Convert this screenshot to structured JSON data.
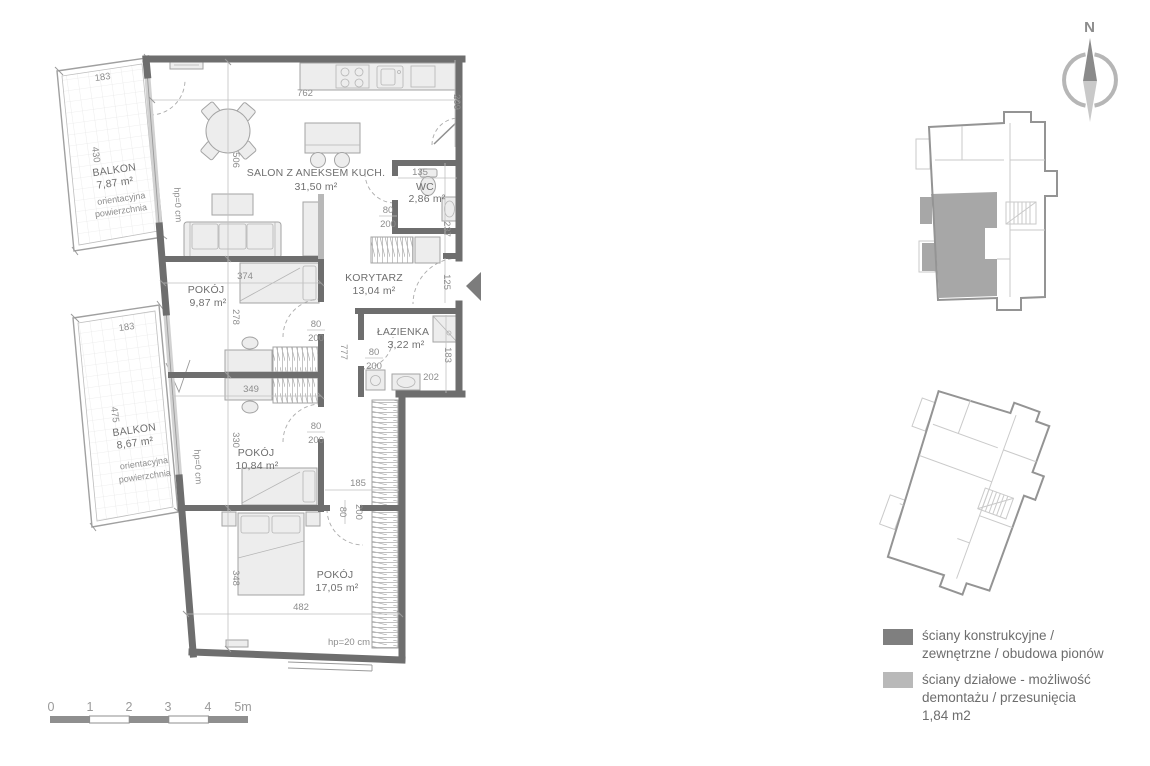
{
  "compass": {
    "north": "N"
  },
  "rooms": {
    "salon": {
      "name": "SALON Z ANEKSEM KUCH.",
      "area": "31,50 m²"
    },
    "wc": {
      "name": "WC",
      "area": "2,86 m²"
    },
    "korytarz": {
      "name": "KORYTARZ",
      "area": "13,04 m²"
    },
    "pokoj1": {
      "name": "POKÓJ",
      "area": "9,87 m²"
    },
    "lazienka": {
      "name": "ŁAZIENKA",
      "area": "3,22 m²"
    },
    "pokoj2": {
      "name": "POKÓJ",
      "area": "10,84 m²"
    },
    "pokoj3": {
      "name": "POKÓJ",
      "area": "17,05 m²"
    },
    "balkon1": {
      "name": "BALKON",
      "area": "7,87 m²",
      "note_line1": "orientacyjna",
      "note_line2": "powierzchnia"
    },
    "balkon2": {
      "name": "BALKON",
      "area": "8,67 m²",
      "note_line1": "orientacyjna",
      "note_line2": "powierzchnia"
    }
  },
  "dims": {
    "top_width": "762",
    "kitchen_depth": "209",
    "salon_height": "506",
    "wc_width": "135",
    "wc_height": "237",
    "entrance_width": "125",
    "pokoj1_width": "374",
    "pokoj1_height": "278",
    "pokoj2_width": "349",
    "pokoj2_height": "330",
    "pokoj3_width": "482",
    "pokoj3_height": "348",
    "korytarz_niche": "185",
    "korytarz_length": "777",
    "lazienka_width": "202",
    "lazienka_height": "183",
    "balkon1_width": "183",
    "balkon1_height": "430",
    "balkon2_width": "183",
    "balkon2_height": "475",
    "hp_zero": "hp=0 cm",
    "hp_twenty": "hp=20 cm"
  },
  "door": {
    "width": "80",
    "height": "200"
  },
  "scale_bar": {
    "labels": [
      "0",
      "1",
      "2",
      "3",
      "4",
      "5m"
    ]
  },
  "legend": {
    "structural": {
      "line1": "ściany konstrukcyjne /",
      "line2": "zewnętrzne / obudowa pionów"
    },
    "partition": {
      "line1": "ściany działowe - możliwość",
      "line2": "demontażu / przesunięcia",
      "line3": "1,84 m2"
    }
  },
  "colors": {
    "wall_dark": "#6e6e6e",
    "wall_light": "#b8b8b8",
    "highlight": "#a7a7a7"
  }
}
